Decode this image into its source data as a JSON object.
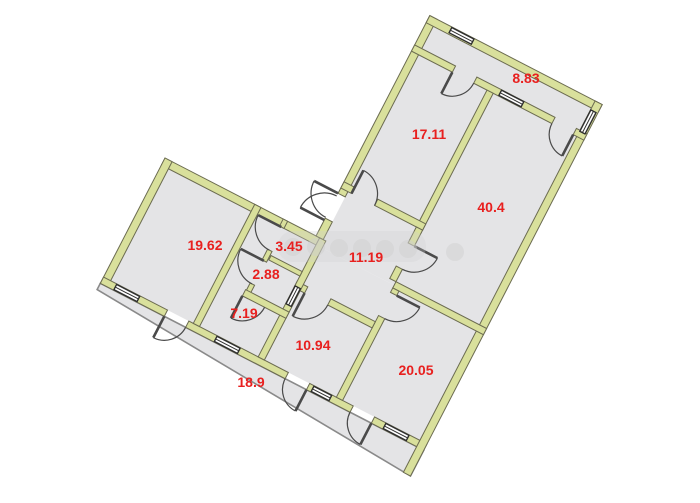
{
  "plan": {
    "canvas": {
      "width": 700,
      "height": 503
    },
    "rotation_deg": 27.3,
    "origin": {
      "x": 165,
      "y": 158
    },
    "colors": {
      "bg": "#ffffff",
      "room_fill": "#e4e4e6",
      "wall_fill": "#d9e09c",
      "wall_stroke": "#6b6b50",
      "thin_outline": "#8a8a8a",
      "door": "#4a4a4a",
      "window_stroke": "#2f2f2f",
      "window_fill": "#ffffff",
      "label": "#e8201f",
      "watermark": "#cfcfcf"
    },
    "regions": [
      {
        "name": "left-wing-interior",
        "type": "rect",
        "x": 8,
        "y": 8,
        "w": 348,
        "h": 126
      },
      {
        "name": "right-wing-interior",
        "type": "rect",
        "x": 178,
        "y": -240,
        "w": 178,
        "h": 248
      },
      {
        "name": "corridor-18.9",
        "type": "poly",
        "points": [
          [
            0,
            141
          ],
          [
            364,
            141
          ],
          [
            364,
            170
          ],
          [
            0,
            148
          ]
        ],
        "thin_stroke": true
      }
    ],
    "walls": [
      {
        "x": 0,
        "y": 0,
        "w": 178,
        "h": 8
      },
      {
        "x": 0,
        "y": 0,
        "w": 8,
        "h": 141
      },
      {
        "x": 0,
        "y": 134,
        "w": 72,
        "h": 7
      },
      {
        "x": 96,
        "y": 134,
        "w": 112,
        "h": 7
      },
      {
        "x": 232,
        "y": 134,
        "w": 49,
        "h": 7
      },
      {
        "x": 305,
        "y": 134,
        "w": 59,
        "h": 7
      },
      {
        "x": 170,
        "y": -248,
        "w": 8,
        "h": 200
      },
      {
        "x": 170,
        "y": -20,
        "w": 8,
        "h": 20
      },
      {
        "x": 170,
        "y": -248,
        "w": 194,
        "h": 8
      },
      {
        "x": 356,
        "y": -248,
        "w": 8,
        "h": 418
      },
      {
        "x": 170,
        "y": -215,
        "w": 46,
        "h": 7
      },
      {
        "x": 240,
        "y": -215,
        "w": 88,
        "h": 7
      },
      {
        "x": 352,
        "y": -215,
        "w": 12,
        "h": 7
      },
      {
        "x": 255,
        "y": -208,
        "w": 7,
        "h": 154
      },
      {
        "x": 170,
        "y": -61,
        "w": 12,
        "h": 7
      },
      {
        "x": 208,
        "y": -61,
        "w": 54,
        "h": 7
      },
      {
        "x": 255,
        "y": -54,
        "w": 7,
        "h": 18
      },
      {
        "x": 255,
        "y": -10,
        "w": 7,
        "h": 14
      },
      {
        "x": 262,
        "y": 4,
        "w": 102,
        "h": 7
      },
      {
        "x": 262,
        "y": 11,
        "w": 7,
        "h": 5
      },
      {
        "x": 262,
        "y": 42,
        "w": 7,
        "h": 92
      },
      {
        "x": 174,
        "y": 49,
        "w": 12,
        "h": 7
      },
      {
        "x": 212,
        "y": 49,
        "w": 50,
        "h": 7
      },
      {
        "x": 174,
        "y": 0,
        "w": 7,
        "h": 134
      },
      {
        "x": 101,
        "y": 0,
        "w": 7,
        "h": 134
      },
      {
        "x": 133,
        "y": 0,
        "w": 5,
        "h": 8
      },
      {
        "x": 133,
        "y": 34,
        "w": 5,
        "h": 12
      },
      {
        "x": 133,
        "y": 72,
        "w": 5,
        "h": 15
      },
      {
        "x": 139,
        "y": 38,
        "w": 35,
        "h": 5
      },
      {
        "x": 132,
        "y": 80,
        "w": 49,
        "h": 7
      }
    ],
    "windows": [
      {
        "name": "window-19.62",
        "x": 15,
        "y": 134.6,
        "w": 26,
        "h": 5.8
      },
      {
        "name": "window-7.19",
        "x": 128,
        "y": 134.6,
        "w": 26,
        "h": 5.8
      },
      {
        "name": "window-10.94",
        "x": 237,
        "y": 134.6,
        "w": 20,
        "h": 5.8
      },
      {
        "name": "window-20.05",
        "x": 318,
        "y": 134.6,
        "w": 26,
        "h": 5.8
      },
      {
        "name": "window-8.83",
        "x": 268,
        "y": -214.6,
        "w": 25,
        "h": 5.8
      },
      {
        "name": "window-top",
        "x": 195,
        "y": -247.4,
        "w": 25,
        "h": 5.8
      },
      {
        "name": "window-right",
        "x": 356.4,
        "y": -238,
        "w": 5.8,
        "h": 24
      },
      {
        "name": "window-2.88",
        "x": 174.4,
        "y": 54,
        "w": 5.8,
        "h": 20
      }
    ],
    "doors": [
      {
        "name": "door-3.45",
        "hx": 135,
        "hy": 8,
        "r": 26,
        "a0": 90,
        "a1": 180,
        "leaf": "a1"
      },
      {
        "name": "door-2.88",
        "hx": 135,
        "hy": 46,
        "r": 26,
        "a0": 90,
        "a1": 180,
        "leaf": "a1"
      },
      {
        "name": "door-7.19",
        "hx": 132,
        "hy": 87,
        "r": 25,
        "a0": 0,
        "a1": 90,
        "leaf": "a1"
      },
      {
        "name": "door-entrance-1",
        "hx": 170,
        "hy": -48,
        "r": 27,
        "a0": 90,
        "a1": 180,
        "leaf": "a1"
      },
      {
        "name": "door-entrance-2",
        "hx": 170,
        "hy": -18,
        "r": 27,
        "a0": 180,
        "a1": 270,
        "leaf": "a0"
      },
      {
        "name": "door-17.11",
        "hx": 182,
        "hy": -54,
        "r": 26,
        "a0": 270,
        "a1": 360,
        "leaf": "a0"
      },
      {
        "name": "door-8.83-17.11",
        "hx": 216,
        "hy": -208,
        "r": 24,
        "a0": 0,
        "a1": 90,
        "leaf": "a1"
      },
      {
        "name": "door-8.83-40.4",
        "hx": 352,
        "hy": -208,
        "r": 24,
        "a0": 90,
        "a1": 180,
        "leaf": "a0"
      },
      {
        "name": "door-40.4",
        "hx": 262,
        "hy": -36,
        "r": 26,
        "a0": 0,
        "a1": 90,
        "leaf": "a0"
      },
      {
        "name": "door-10.94",
        "hx": 186,
        "hy": 56,
        "r": 26,
        "a0": 0,
        "a1": 90,
        "leaf": "a1"
      },
      {
        "name": "door-20.05",
        "hx": 269,
        "hy": 16,
        "r": 26,
        "a0": 0,
        "a1": 90,
        "leaf": "a0"
      },
      {
        "name": "door-corridor-1",
        "hx": 72,
        "hy": 141,
        "r": 24,
        "a0": 0,
        "a1": 90,
        "leaf": "a1"
      },
      {
        "name": "door-corridor-2",
        "hx": 232,
        "hy": 141,
        "r": 24,
        "a0": 90,
        "a1": 180,
        "leaf": "a0"
      },
      {
        "name": "door-corridor-3",
        "hx": 305,
        "hy": 141,
        "r": 24,
        "a0": 90,
        "a1": 180,
        "leaf": "a0"
      }
    ],
    "labels": [
      {
        "room": "room-19.62",
        "text": "19.62",
        "x": 205,
        "y": 245
      },
      {
        "room": "room-3.45",
        "text": "3.45",
        "x": 289,
        "y": 246
      },
      {
        "room": "room-2.88",
        "text": "2.88",
        "x": 266,
        "y": 274
      },
      {
        "room": "room-7.19",
        "text": "7.19",
        "x": 244,
        "y": 313
      },
      {
        "room": "room-10.94",
        "text": "10.94",
        "x": 313,
        "y": 345
      },
      {
        "room": "corridor-18.9",
        "text": "18.9",
        "x": 251,
        "y": 382
      },
      {
        "room": "room-20.05",
        "text": "20.05",
        "x": 416,
        "y": 370
      },
      {
        "room": "hall-11.19",
        "text": "11.19",
        "x": 366,
        "y": 257
      },
      {
        "room": "room-17.11",
        "text": "17.11",
        "x": 429,
        "y": 134
      },
      {
        "room": "room-40.4",
        "text": "40.4",
        "x": 491,
        "y": 207
      },
      {
        "room": "loggia-8.83",
        "text": "8.83",
        "x": 526,
        "y": 78
      }
    ],
    "label_font_px": 14,
    "watermark": {
      "band": {
        "x": 278,
        "y": 231,
        "w": 148,
        "h": 31,
        "r": 15
      },
      "dot_r": 9,
      "dots": [
        {
          "x": 293,
          "y": 247
        },
        {
          "x": 316,
          "y": 247
        },
        {
          "x": 339,
          "y": 248
        },
        {
          "x": 362,
          "y": 248
        },
        {
          "x": 385,
          "y": 249
        },
        {
          "x": 408,
          "y": 249
        },
        {
          "x": 455,
          "y": 252
        }
      ]
    }
  }
}
